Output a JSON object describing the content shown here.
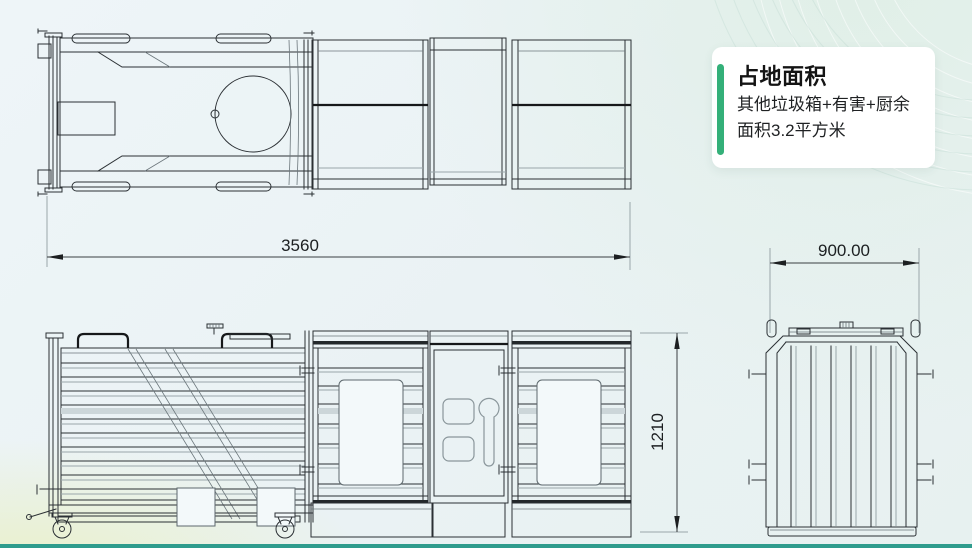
{
  "info_card": {
    "title": "占地面积",
    "body_line1": "其他垃圾箱+有害+厨余",
    "body_line2": "面积3.2平方米",
    "accent_color": "#34b079"
  },
  "dimensions": {
    "overall_length_mm": "3560",
    "overall_height_mm": "1210",
    "overall_width_mm": "900.00"
  },
  "theme": {
    "bottom_bar_color": "#2f9c8d",
    "line_color": "#2b3034"
  }
}
